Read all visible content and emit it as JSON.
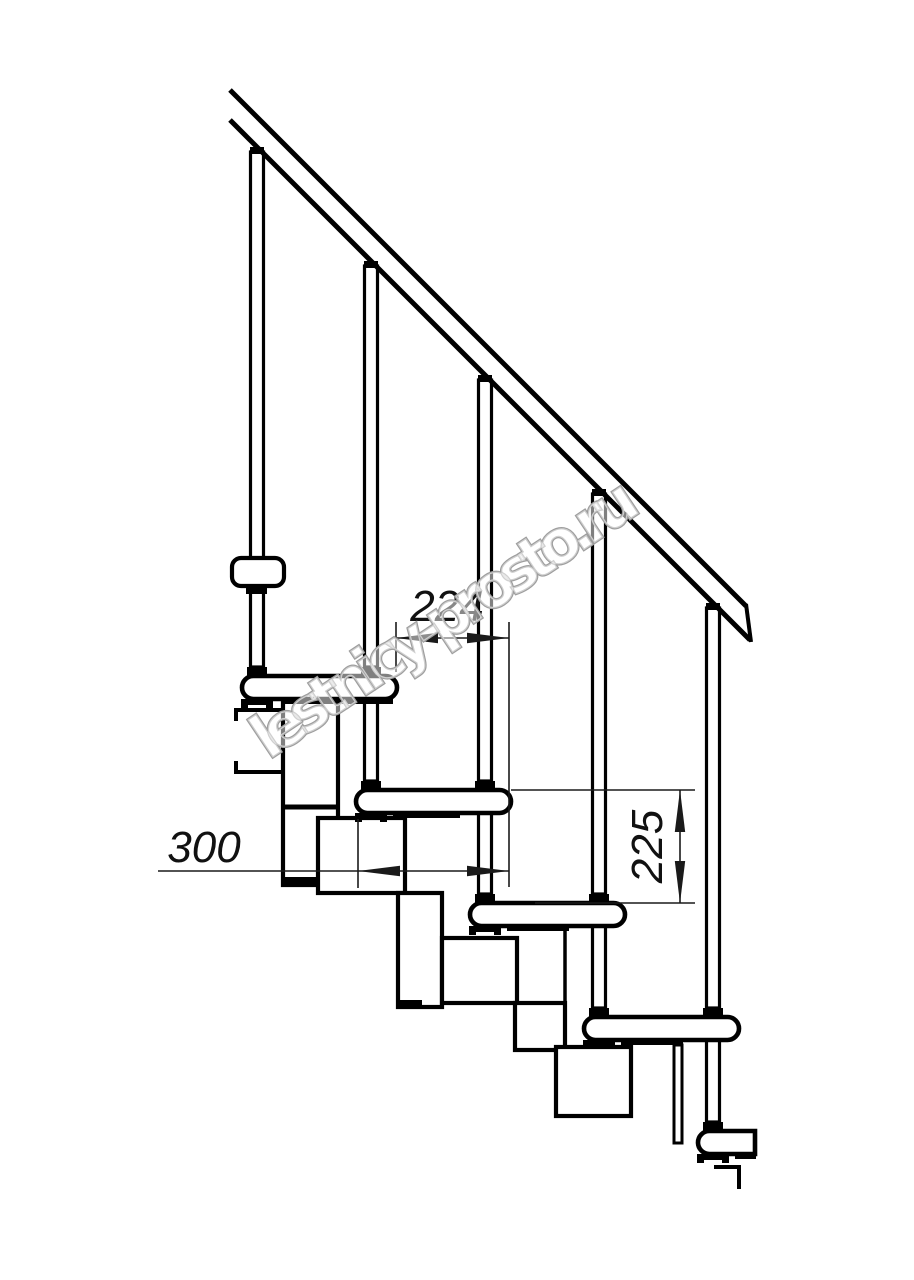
{
  "drawing": {
    "watermark_text": "lestnicy-prosto.ru",
    "dimensions": {
      "going_label": "224",
      "tread_depth_label": "300",
      "rise_label": "225"
    }
  }
}
